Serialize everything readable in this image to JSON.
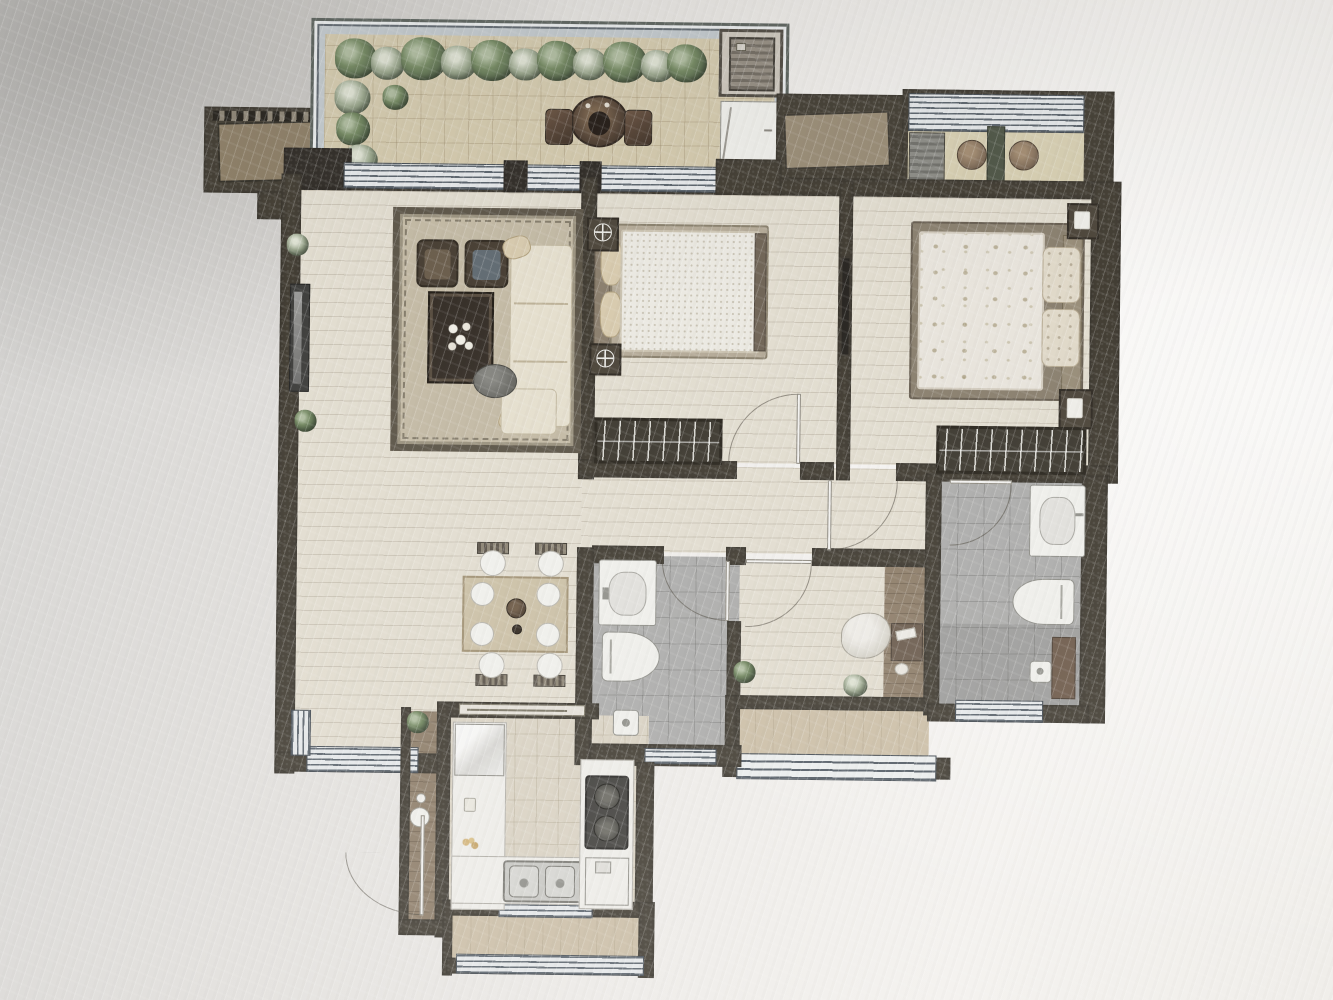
{
  "photo": {
    "subject": "furnished apartment floor plan, top-down rendered view",
    "presentation": "photograph of a printed plan, slightly tilted, no text labels visible",
    "background": "light gray-white textured paper with diagonal sheen streaks"
  },
  "colors": {
    "wall": "#3e382c",
    "wallDark": "#2b261f",
    "floorWood": "#e6dfd0",
    "balconyTile": "#d8cba9",
    "bathTile": "#adadab",
    "kitchenTile": "#ddd5c2",
    "rearBalcony": "#cfc0a3",
    "studyMat": "#8f7c64",
    "windowStripe": "#56616c",
    "windowBase": "#e7ebed",
    "rug": "#c6bba2",
    "rugBorder": "#5b5242",
    "sofa": "#e9e1cd",
    "darkFurniture": "#453a2c",
    "hedgeGreen": "#6d8757",
    "fixtureWhite": "#f3f2ee"
  },
  "rooms": [
    {
      "id": "garden-balcony",
      "label": "garden balcony",
      "items": [
        "hedge planting along parapet",
        "tan tiled floor",
        "round tea table",
        "two planter pots",
        "air-conditioner closet",
        "white storage cabinet"
      ]
    },
    {
      "id": "side-balcony",
      "label": "secondary balcony",
      "items": [
        "striped window wall",
        "two round stools",
        "dark partition"
      ]
    },
    {
      "id": "living-room",
      "label": "living room",
      "items": [
        "bordered area rug",
        "cream corner sofa",
        "two dark armchairs",
        "dark coffee table with white flowers",
        "gray ottoman",
        "wall-mounted tv"
      ]
    },
    {
      "id": "dining-area",
      "label": "dining area",
      "items": [
        "rectangular table",
        "four chairs",
        "four place settings",
        "teapot"
      ]
    },
    {
      "id": "bedroom-second",
      "label": "second bedroom",
      "items": [
        "double bed with knit cover",
        "two nightstand lamps",
        "wardrobe with hangers",
        "inward-swinging door"
      ]
    },
    {
      "id": "master-bedroom",
      "label": "master bedroom",
      "items": [
        "double bed with floral cover",
        "tufted pillows",
        "two nightstand lamps",
        "wardrobe with hangers",
        "wall tv niche"
      ]
    },
    {
      "id": "hallway",
      "label": "hallway",
      "items": [
        "door swings to bedrooms and bathrooms"
      ]
    },
    {
      "id": "shared-bathroom",
      "label": "shared bathroom",
      "items": [
        "washbasin",
        "toilet",
        "shower area with floor drain",
        "bottom window"
      ]
    },
    {
      "id": "master-bathroom",
      "label": "master bathroom",
      "items": [
        "washbasin",
        "toilet",
        "shower area with floor drain",
        "vanity strip",
        "bottom window"
      ]
    },
    {
      "id": "study",
      "label": "study / flex room",
      "items": [
        "bean-bag seat",
        "low desk on wood mat",
        "potted plants"
      ]
    },
    {
      "id": "rear-balcony",
      "label": "rear balcony",
      "items": [
        "full-width window band"
      ]
    },
    {
      "id": "kitchen",
      "label": "kitchen",
      "items": [
        "refrigerator",
        "l-shaped counter",
        "double stainless sink",
        "two-burner cooktop",
        "base cabinet"
      ]
    },
    {
      "id": "service-balcony",
      "label": "service balcony",
      "items": [
        "window bands on two sides"
      ]
    },
    {
      "id": "entry",
      "label": "entry",
      "items": [
        "console strip with round decor",
        "entry door swinging outward"
      ]
    },
    {
      "id": "equipment-platform",
      "label": "equipment platform",
      "items": [
        "louvered a/c platform"
      ]
    }
  ]
}
